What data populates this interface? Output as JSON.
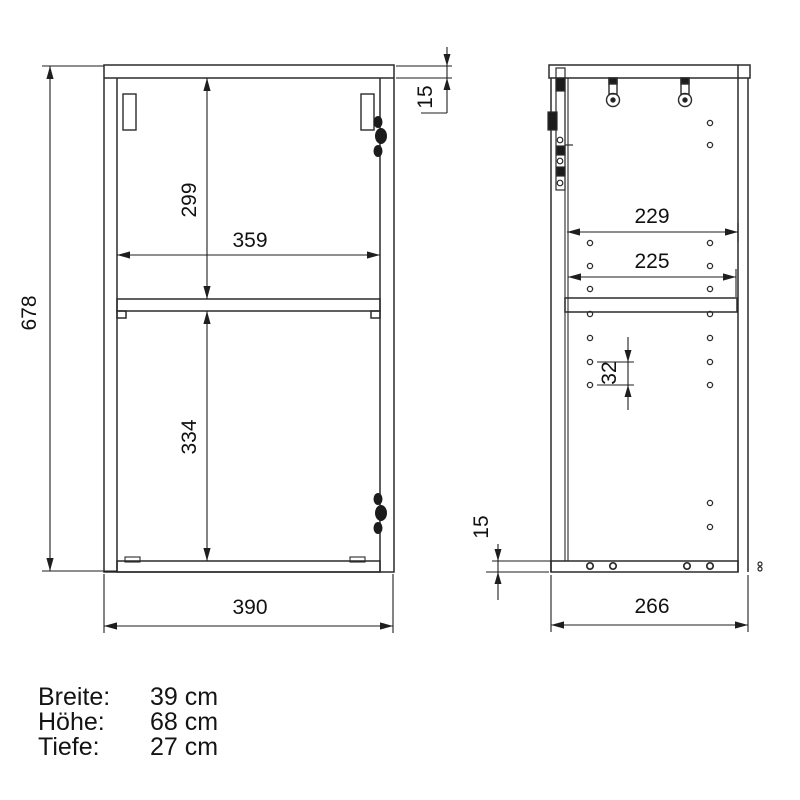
{
  "drawing": {
    "title": "wall cabinet technical drawing, front and side view",
    "front_view": {
      "overall_height_mm": "678",
      "top_panel_thickness_mm": "15",
      "upper_compartment_height_mm": "299",
      "inner_width_mm": "359",
      "lower_compartment_height_mm": "334",
      "overall_width_mm": "390"
    },
    "side_view": {
      "inner_depth_mm": "229",
      "shelf_depth_mm": "225",
      "hole_pitch_mm": "32",
      "bottom_panel_thickness_mm": "15",
      "overall_depth_mm": "266"
    }
  },
  "specs": {
    "rows": [
      {
        "label": "Breite:",
        "value": "39 cm"
      },
      {
        "label": "Höhe:",
        "value": "68 cm"
      },
      {
        "label": "Tiefe:",
        "value": "27 cm"
      }
    ]
  }
}
